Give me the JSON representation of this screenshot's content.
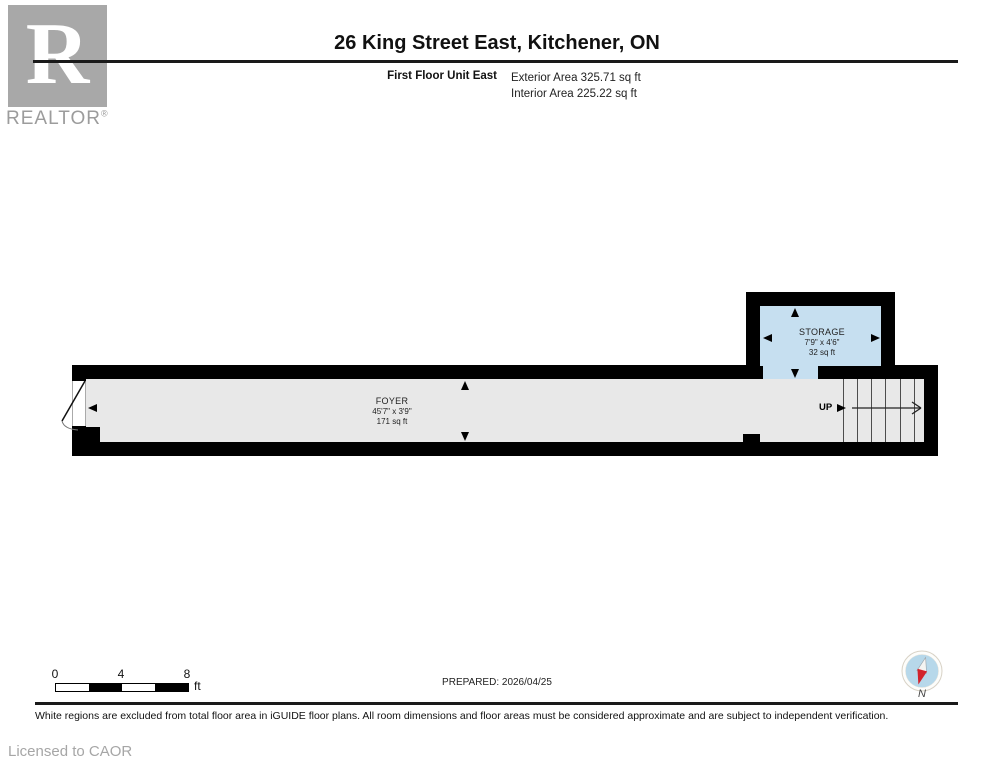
{
  "header": {
    "logo_letter": "R",
    "logo_brand": "REALTOR",
    "logo_registered": "®",
    "title": "26 King Street East, Kitchener, ON",
    "floor_label": "First Floor Unit East",
    "exterior_area": "Exterior Area 325.71 sq ft",
    "interior_area": "Interior Area 225.22 sq ft"
  },
  "floorplan": {
    "wall_color": "#000000",
    "rooms": [
      {
        "name": "FOYER",
        "dimensions": "45'7\" x 3'9\"",
        "area": "171 sq ft",
        "fill": "#e8e8e8"
      },
      {
        "name": "STORAGE",
        "dimensions": "7'9\" x 4'6\"",
        "area": "32 sq ft",
        "fill": "#c6dff0"
      }
    ],
    "stairs": {
      "label": "UP",
      "step_count": 7
    }
  },
  "footer": {
    "scale_bar": {
      "tick_labels": [
        "0",
        "4",
        "8"
      ],
      "unit": "ft"
    },
    "prepared_label": "PREPARED: 2026/04/25",
    "compass_label": "N",
    "compass_colors": {
      "circle": "#b7d8ea",
      "needle_north": "#d2232b",
      "needle_south": "#f4f4f2"
    },
    "disclaimer": "White regions are excluded from total floor area in iGUIDE floor plans. All room dimensions and floor areas must be considered approximate and are subject to independent verification.",
    "license": "Licensed to CAOR"
  }
}
